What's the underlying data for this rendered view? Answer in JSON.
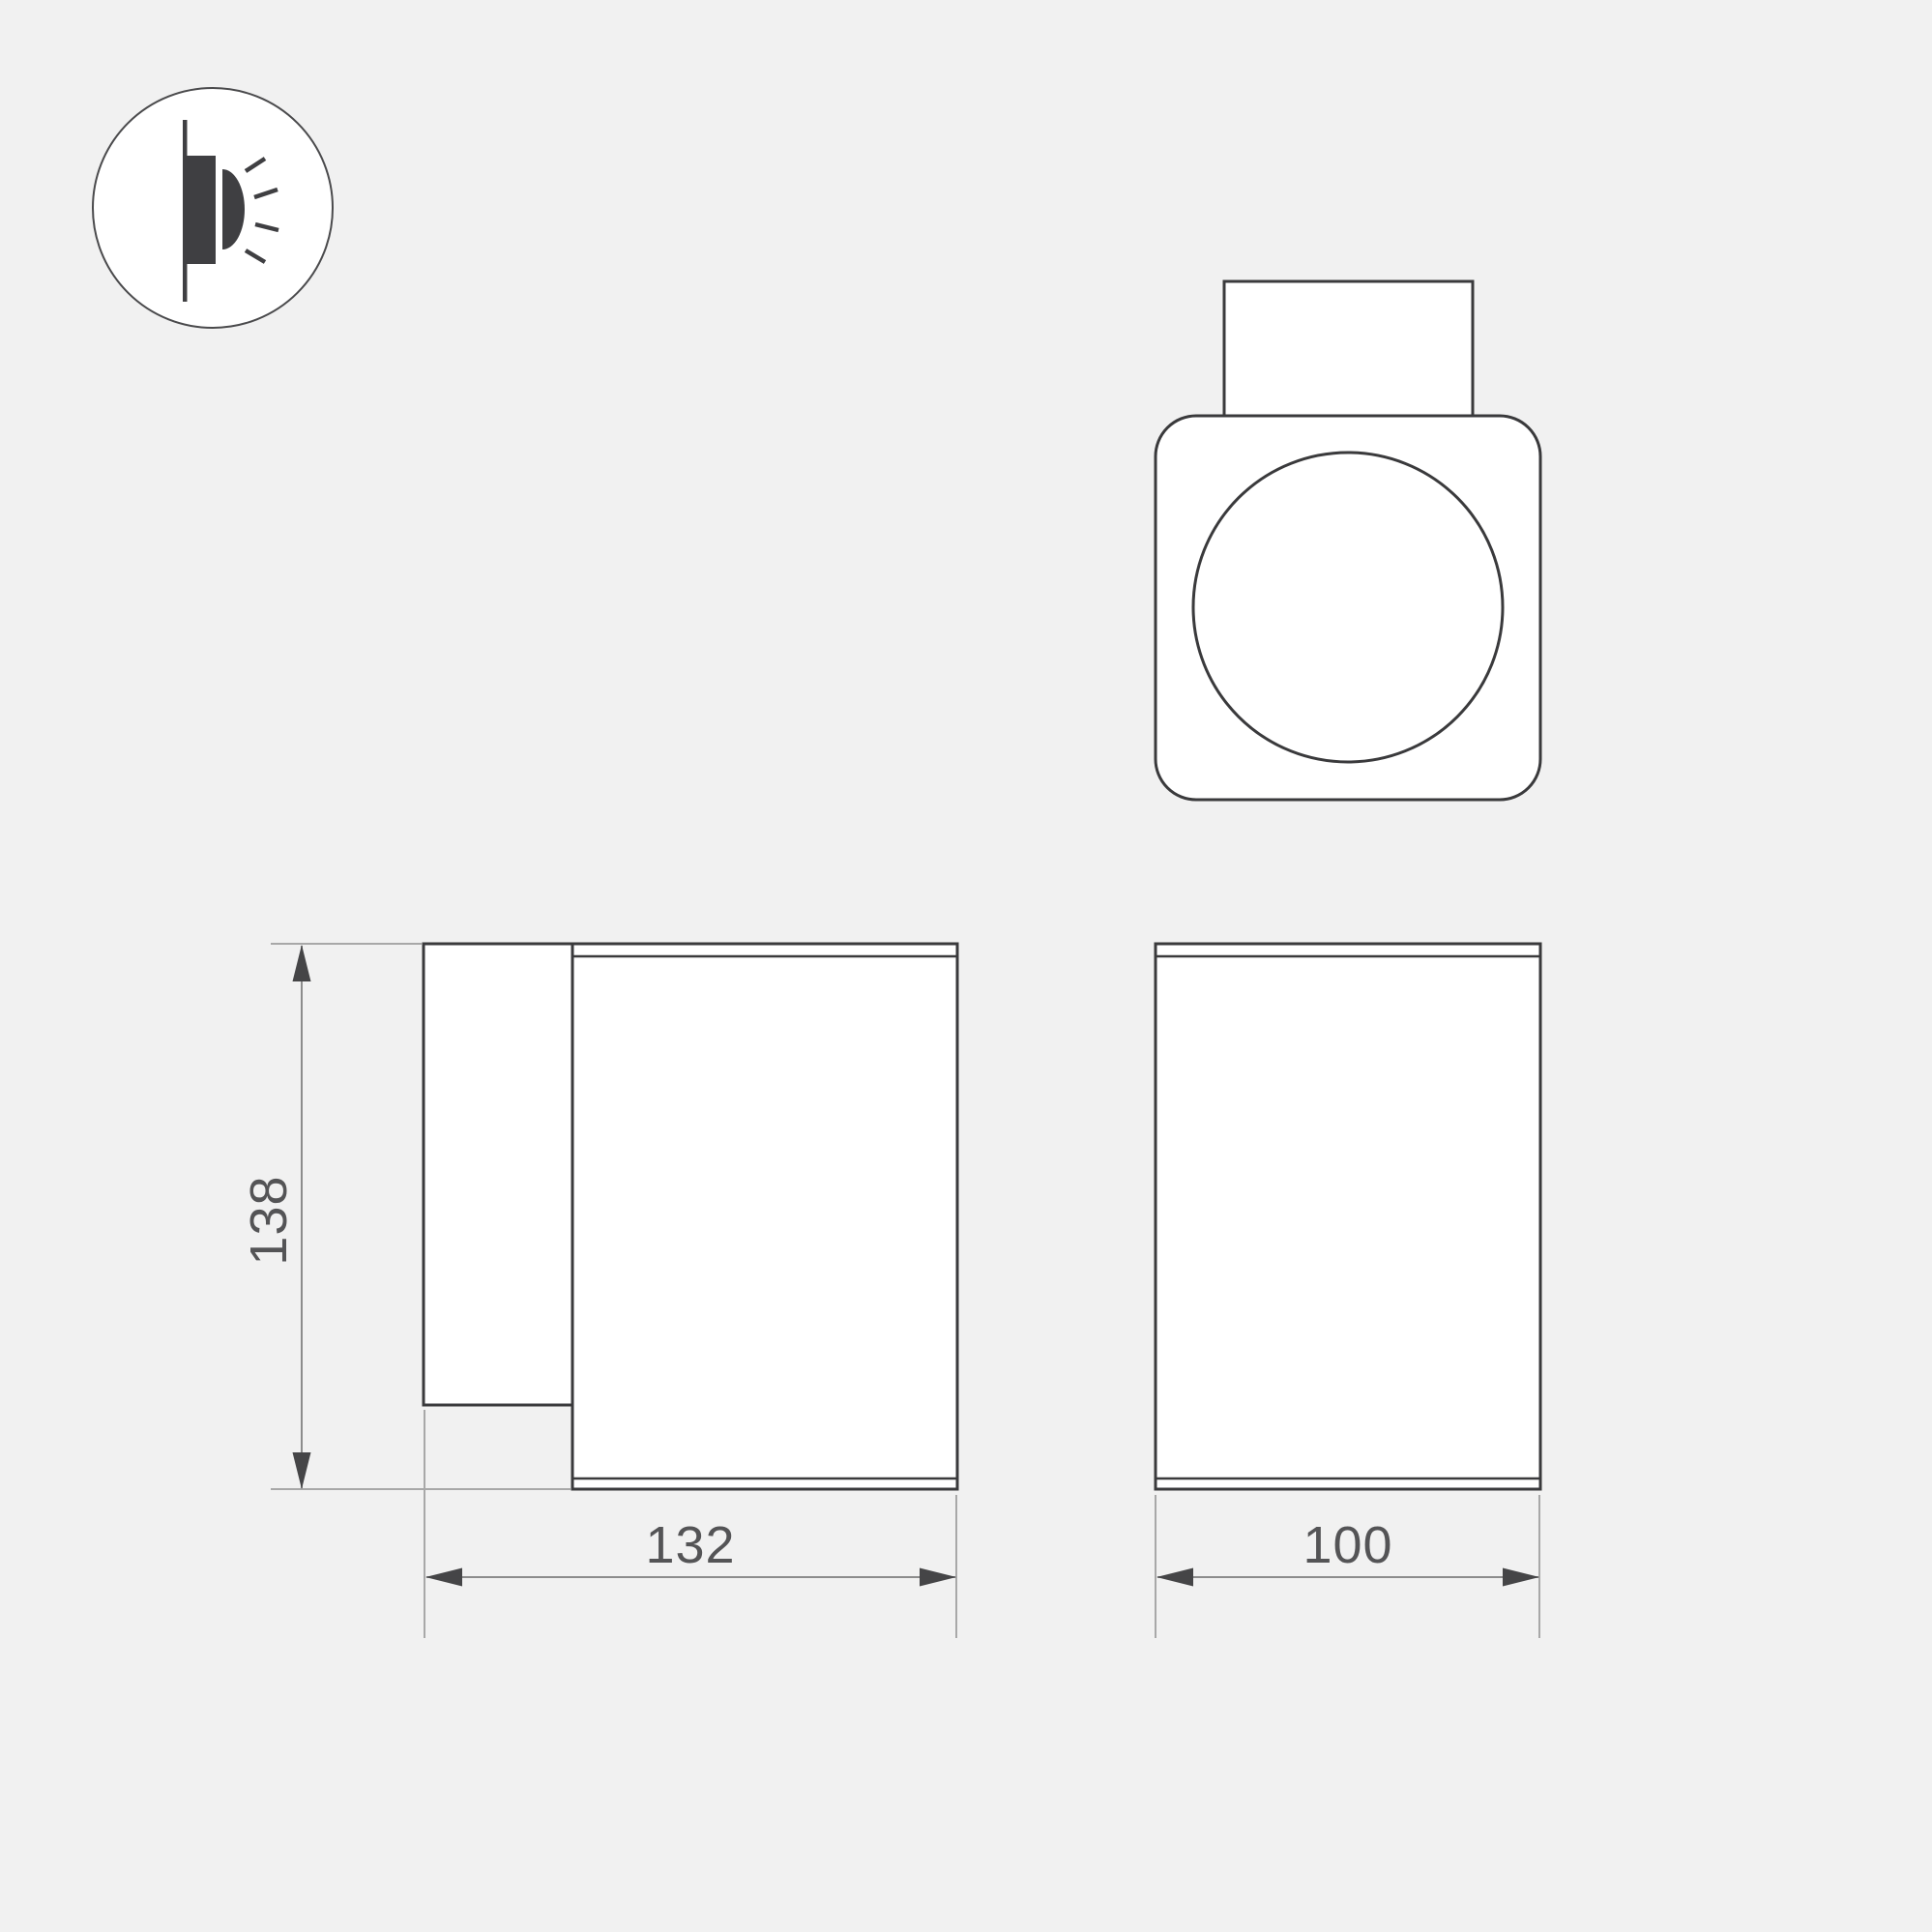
{
  "page": {
    "background": "#f1f1f1",
    "type": "technical-dimension-drawing"
  },
  "colors": {
    "outline": "#3a3a3c",
    "shape_fill": "#ffffff",
    "dimension_line": "#8c8c8c",
    "extension_line": "#a8a8a8",
    "arrow": "#454547",
    "text": "#545456",
    "icon_glyph": "#3f3f42"
  },
  "icon": {
    "name": "wall-mounted-light-icon"
  },
  "dimensions": {
    "height": "138",
    "width": "132",
    "depth": "100"
  }
}
